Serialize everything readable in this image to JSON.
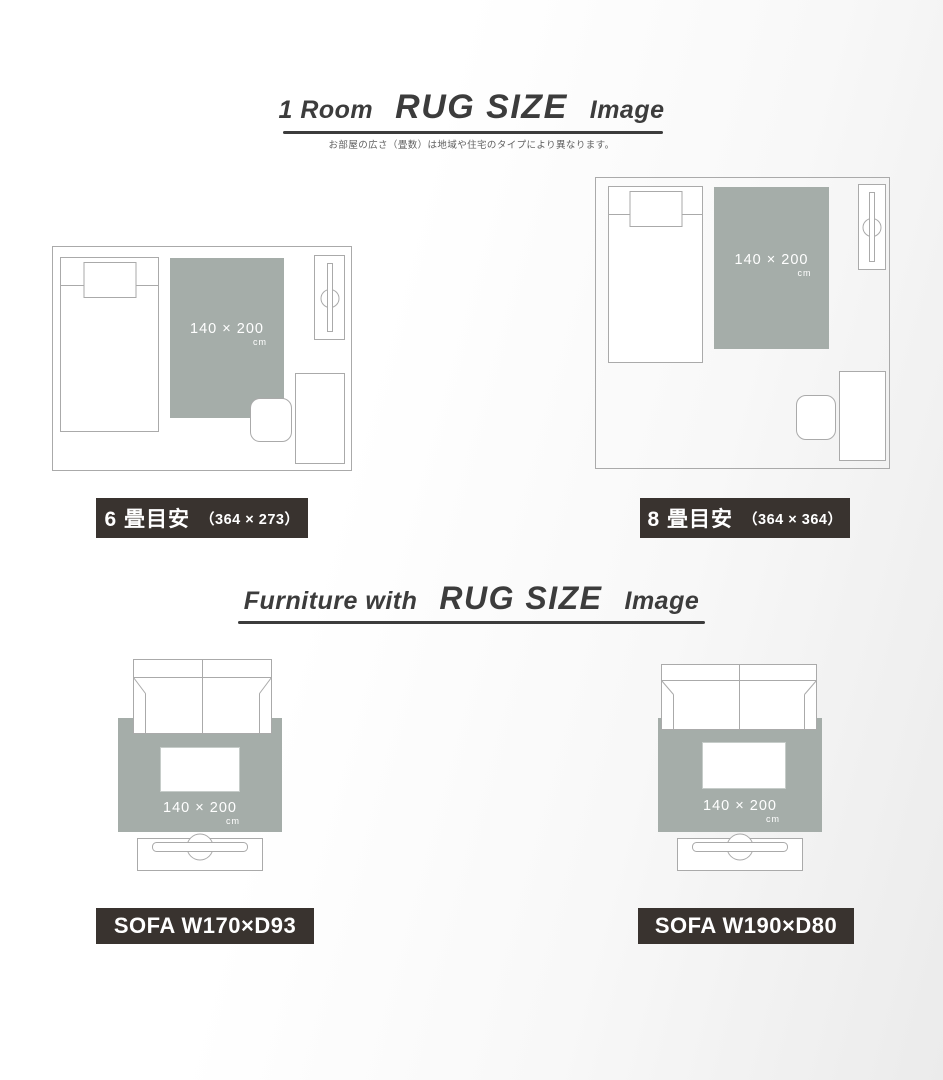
{
  "colors": {
    "rug": "#a5ada9",
    "rug-text": "#ffffff",
    "label-bg": "#39332f",
    "label-text": "#ffffff",
    "outline": "#aaaaaa",
    "title": "#3c3c3c",
    "subtitle-text": "#606060"
  },
  "section1": {
    "title": {
      "prefix": "1 Room",
      "main": "RUG SIZE",
      "suffix": "Image"
    },
    "subtitle": "お部屋の広さ（畳数）は地域や住宅のタイプにより異なります。",
    "room6": {
      "rug_size": "140 × 200",
      "rug_unit": "cm",
      "label": "6 畳目安",
      "dims": "（364 × 273）"
    },
    "room8": {
      "rug_size": "140 × 200",
      "rug_unit": "cm",
      "label": "8 畳目安",
      "dims": "（364 × 364）"
    }
  },
  "section2": {
    "title": {
      "prefix": "Furniture with",
      "main": "RUG SIZE",
      "suffix": "Image"
    },
    "sofa170": {
      "rug_size": "140 × 200",
      "rug_unit": "cm",
      "label": "SOFA W170×D93"
    },
    "sofa190": {
      "rug_size": "140 × 200",
      "rug_unit": "cm",
      "label": "SOFA W190×D80"
    }
  }
}
